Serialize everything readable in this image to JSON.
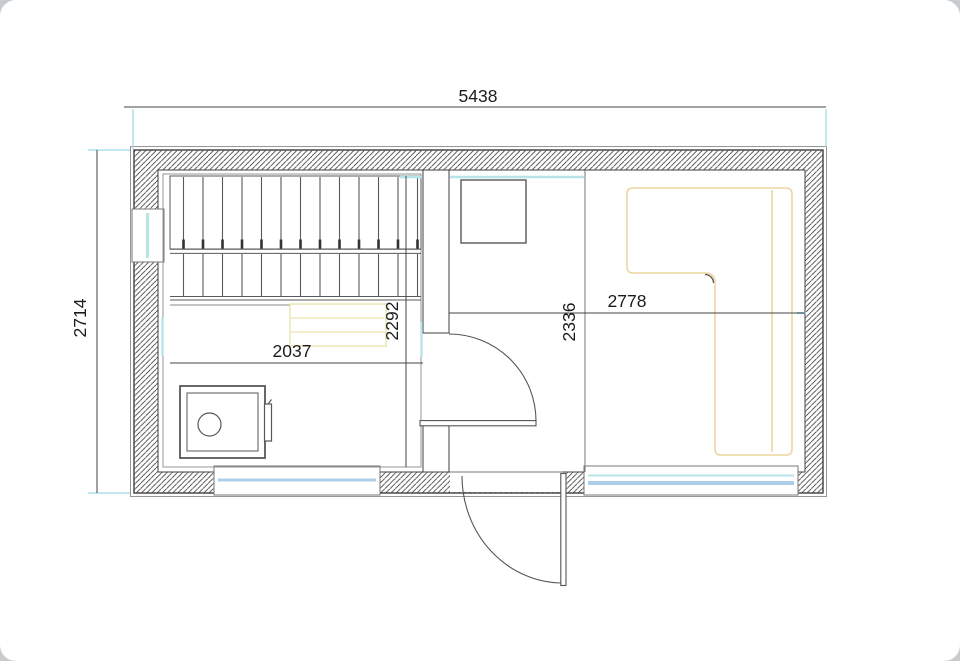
{
  "title": "Sauna building floor plan",
  "dimensions": {
    "overall_width_mm": "5438",
    "overall_depth_mm": "2714",
    "sauna_room_width_mm": "2037",
    "sauna_room_depth_mm": "2292",
    "lounge_section_width_mm": "2778",
    "lounge_room_depth_mm": "2336"
  },
  "colors": {
    "wall_line": "#3f3f3f",
    "thin_line": "#8a8a8a",
    "dimension_text": "#1b1b1b",
    "extension_cyan": "#9adbe3",
    "glass_cyan": "#b7e4e9",
    "glass_blue": "#aecde9",
    "bench_yellow": "#e9e2ab",
    "sofa_tan": "#eed5a2"
  },
  "elements": {
    "sauna_benches": "two-tier slatted sauna benches",
    "step_bench": "bench step",
    "heater": "sauna heater / stove",
    "table": "square table",
    "corner_sofa": "L-shaped corner sofa",
    "interior_door": "door between sauna and lounge",
    "exterior_door": "entrance door",
    "windows": "windows with glazing lines"
  }
}
